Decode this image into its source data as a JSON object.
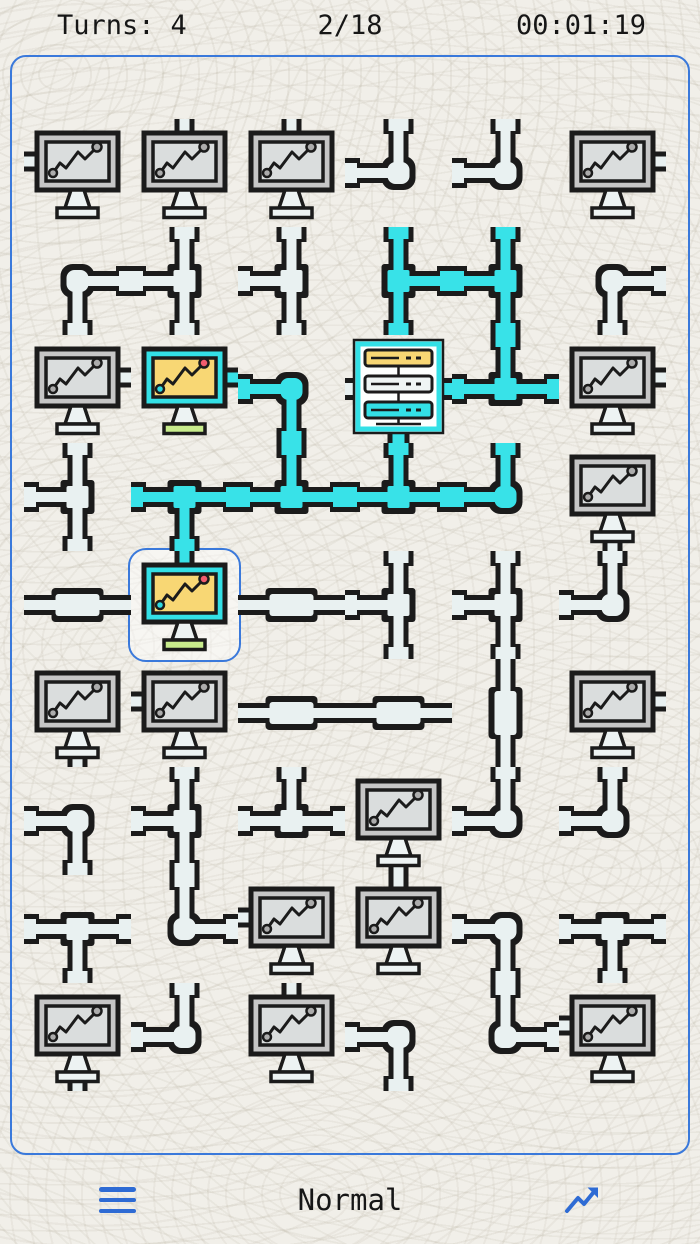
{
  "hud": {
    "turns_label": "Turns:",
    "turns_value": "4",
    "progress": "2/18",
    "timer": "00:01:19"
  },
  "footer": {
    "menu_icon": "hamburger-icon",
    "difficulty": "Normal",
    "stats_icon": "trend-up-icon"
  },
  "colors": {
    "background": "#F1EFE9",
    "accent_blue": "#2E6BD4",
    "board_border_blue": "#3A79DB",
    "pipe_casing": "#1B1B1B",
    "pipe_off": "#E9F1F1",
    "pipe_on": "#38E2E8",
    "frame_off": "#C6C6C6",
    "screen_off": "#DADDDD",
    "dot_off": "#ACACAC",
    "frame_on_cyan": "#33E0E6",
    "screen_on_yellow": "#F8D774",
    "dot_start_cyan": "#2FD9E0",
    "dot_end_red": "#F25C6E",
    "base_green": "#C8EC8C",
    "stand_light": "#EDF3F3",
    "server_white": "#FDFFFE",
    "server_unit_yellow": "#F8D774",
    "server_unit_white": "#EFF5F4",
    "server_unit_cyan": "#33E0E6"
  },
  "board": {
    "rows": 9,
    "cols": 6,
    "connected_count": 2,
    "total_computers": 18,
    "selected": {
      "row": 5,
      "col": 2
    },
    "tile_legend": {
      "computer": "monitor node, letter = side of its connector (N/E/S/W)",
      "server": "rack source with W/E/S stubs",
      "elbow": "corner pipe, letters = open sides",
      "tee": "three-way pipe, letters = open sides",
      "straight": "straight pipe, letters = open sides",
      "on_suffix": "tile is connected to the server (cyan / lit)"
    },
    "tiles": [
      [
        "computer:W",
        "computer:N",
        "computer:N",
        "elbow:NW",
        "elbow:NW",
        "computer:E"
      ],
      [
        "elbow:ES",
        "tee:NSW",
        "tee:NSW",
        "tee:NSE:on",
        "tee:NSW:on",
        "elbow:ES"
      ],
      [
        "computer:E",
        "computer:E:on",
        "elbow:WS:on",
        "server",
        "tee:NWE:on",
        "computer:E"
      ],
      [
        "tee:NSW",
        "tee:WES:on",
        "tee:WEN:on",
        "tee:WEN:on",
        "elbow:WN:on",
        "computer:S"
      ],
      [
        "straight:WE",
        "computer:N:on",
        "straight:WE",
        "tee:NSW",
        "tee:NSW",
        "elbow:NW"
      ],
      [
        "computer:S",
        "computer:W",
        "straight:WE",
        "straight:WE",
        "straight:NS",
        "computer:E"
      ],
      [
        "elbow:WS",
        "tee:NSW",
        "tee:WEN",
        "computer:S",
        "elbow:NW",
        "elbow:NW"
      ],
      [
        "tee:WES",
        "elbow:NE",
        "computer:W",
        "computer:N",
        "elbow:WS",
        "tee:WES"
      ],
      [
        "computer:S",
        "elbow:NW",
        "computer:N",
        "elbow:WS",
        "elbow:NE",
        "computer:W"
      ]
    ]
  }
}
